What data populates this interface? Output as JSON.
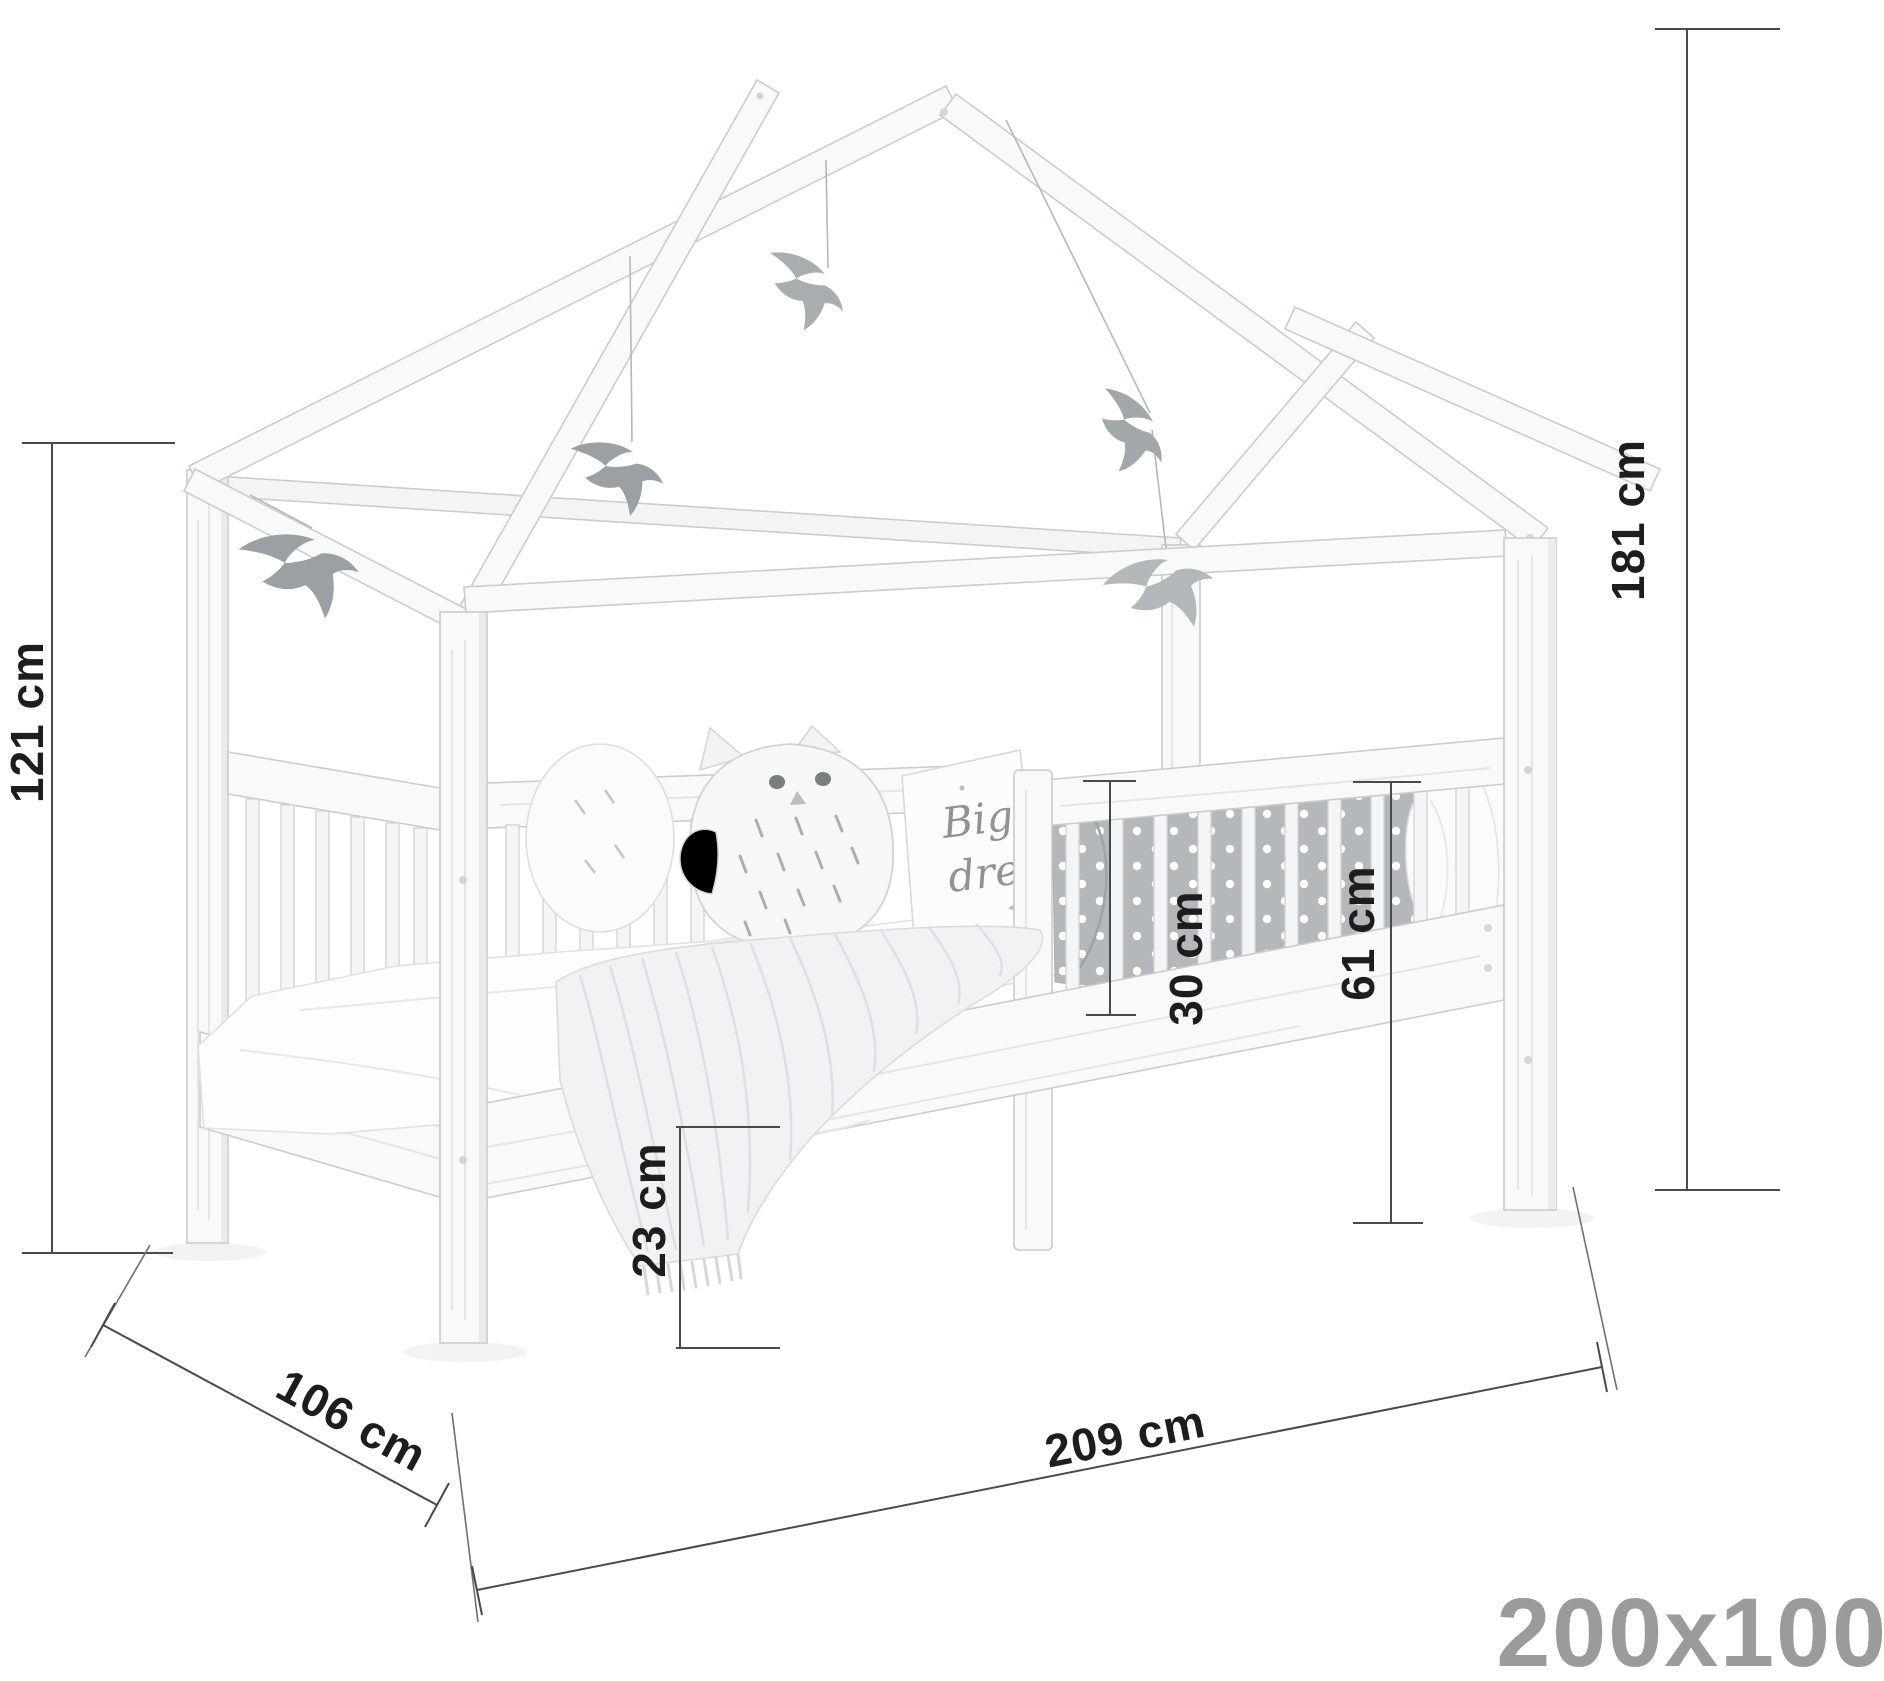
{
  "page": {
    "background": "#ffffff"
  },
  "figure": {
    "type": "furniture-dimension-diagram",
    "subject": "house-frame-children-bed",
    "size_label": "200x100",
    "colors": {
      "dimension_line": "#4a4a4a",
      "dimension_text": "#1d1d1d",
      "size_label_text": "#9b9b9b",
      "wood_outline": "#c9cdd0",
      "dotted_fabric": "#b4b8bb",
      "bird_silhouette": "#9aa0a4"
    },
    "dimensions": {
      "total_height": "181 cm",
      "wall_height": "121 cm",
      "under_bed_clearance": "23 cm",
      "rail_above_mattress": "30 cm",
      "rail_total_height": "61 cm",
      "depth": "106 cm",
      "length": "209 cm"
    },
    "pillow_text": {
      "line1": "Big h",
      "line2": "dream"
    }
  }
}
